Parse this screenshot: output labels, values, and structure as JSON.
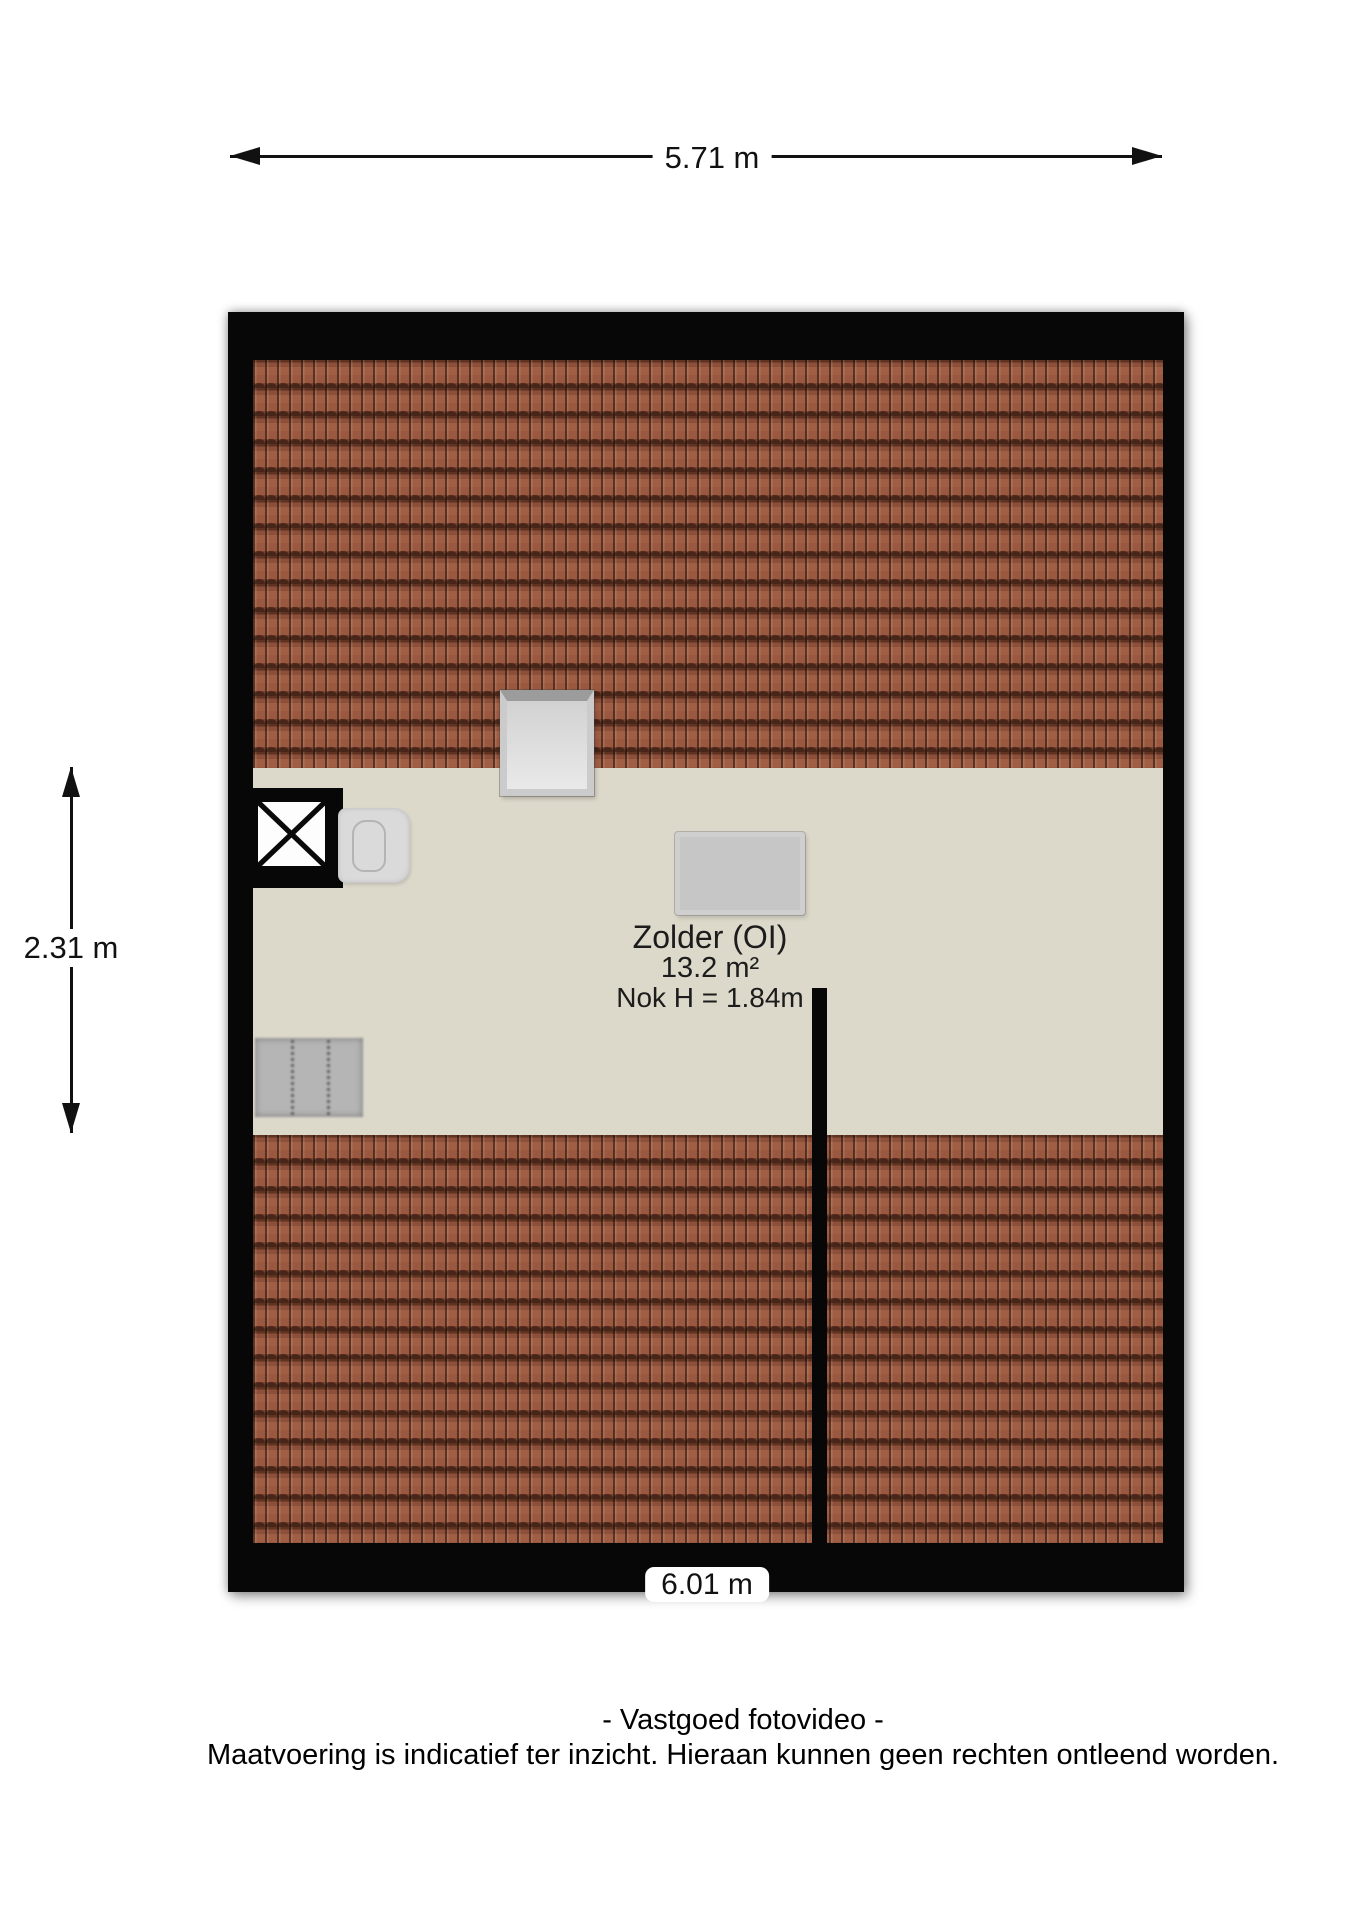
{
  "dimensions": {
    "top_width": "5.71 m",
    "left_height": "2.31 m",
    "bottom_width": "6.01 m"
  },
  "room": {
    "name": "Zolder (OI)",
    "area": "13.2 m²",
    "ridge_height": "Nok H = 1.84m"
  },
  "footer": {
    "credit": "- Vastgoed fotovideo -",
    "disclaimer": "Maatvoering is indicatief ter inzicht. Hieraan kunnen geen rechten ontleend worden."
  },
  "colors": {
    "wall": "#070707",
    "roof_tile": "#96573e",
    "roof_tile_gap": "#5e3120",
    "floor": "#dcd8ca",
    "object_gray": "#c6c6c6",
    "background": "#ffffff"
  }
}
